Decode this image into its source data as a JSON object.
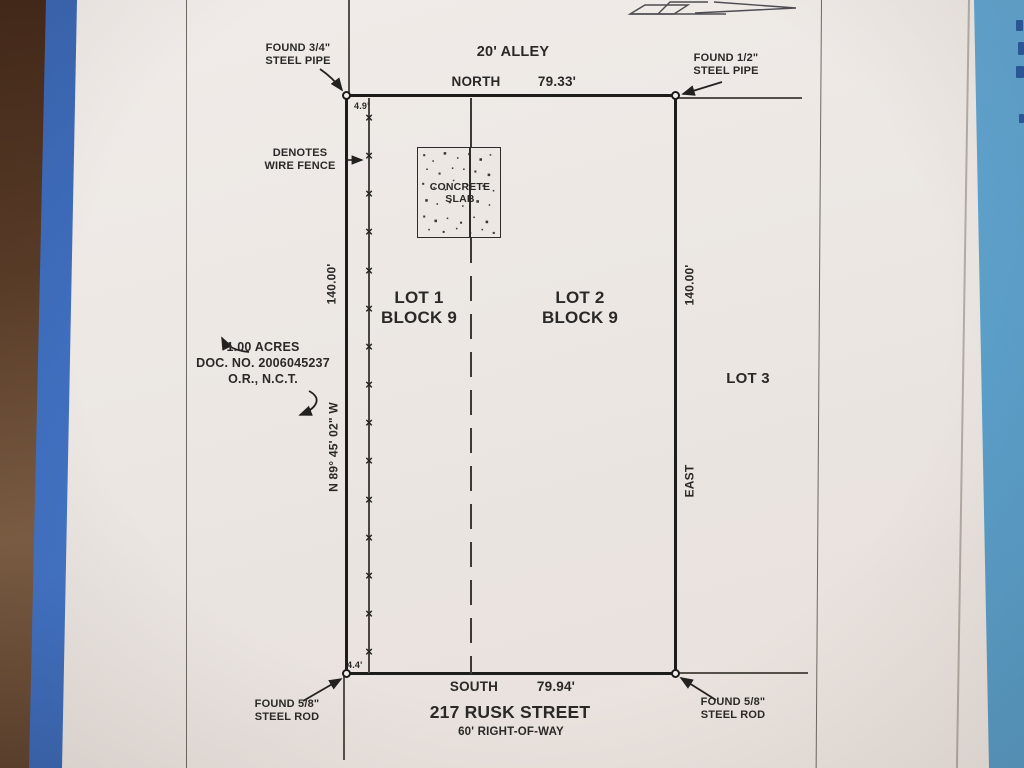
{
  "paper": {
    "alley_label": "20' ALLEY",
    "north_bearing": "NORTH",
    "north_distance": "79.33'",
    "south_bearing": "SOUTH",
    "south_distance": "79.94'",
    "west_bearing": "N 89° 45' 02\" W",
    "west_distance": "140.00'",
    "east_bearing": "EAST",
    "east_distance": "140.00'",
    "monument_nw": {
      "line1": "FOUND 3/4\"",
      "line2": "STEEL PIPE"
    },
    "monument_ne": {
      "line1": "FOUND 1/2\"",
      "line2": "STEEL PIPE"
    },
    "monument_sw": {
      "line1": "FOUND 5/8\"",
      "line2": "STEEL ROD"
    },
    "monument_se": {
      "line1": "FOUND 5/8\"",
      "line2": "STEEL ROD"
    },
    "fence_note": {
      "line1": "DENOTES",
      "line2": "WIRE FENCE"
    },
    "fence_offset_top": "4.9'",
    "fence_offset_bottom": "4.4'",
    "fence_marks": {
      "symbol": "×",
      "count": 15
    },
    "slab": {
      "line1": "CONCRETE",
      "line2": "SLAB"
    },
    "lot1": {
      "line1": "LOT 1",
      "line2": "BLOCK 9"
    },
    "lot2": {
      "line1": "LOT 2",
      "line2": "BLOCK 9"
    },
    "lot3": "LOT 3",
    "acreage": {
      "line1": "1.00 ACRES",
      "line2": "DOC. NO. 2006045237",
      "line3": "O.R., N.C.T."
    },
    "street_name": "217 RUSK STREET",
    "right_of_way": "60' RIGHT-OF-WAY"
  },
  "colors": {
    "ink": "#2b2927",
    "boundary": "#1e1c1a",
    "paper": "#ece7e3",
    "tape_left": "#3e6dbd",
    "tape_right": "#5b9fc9",
    "table": "#583b27"
  }
}
